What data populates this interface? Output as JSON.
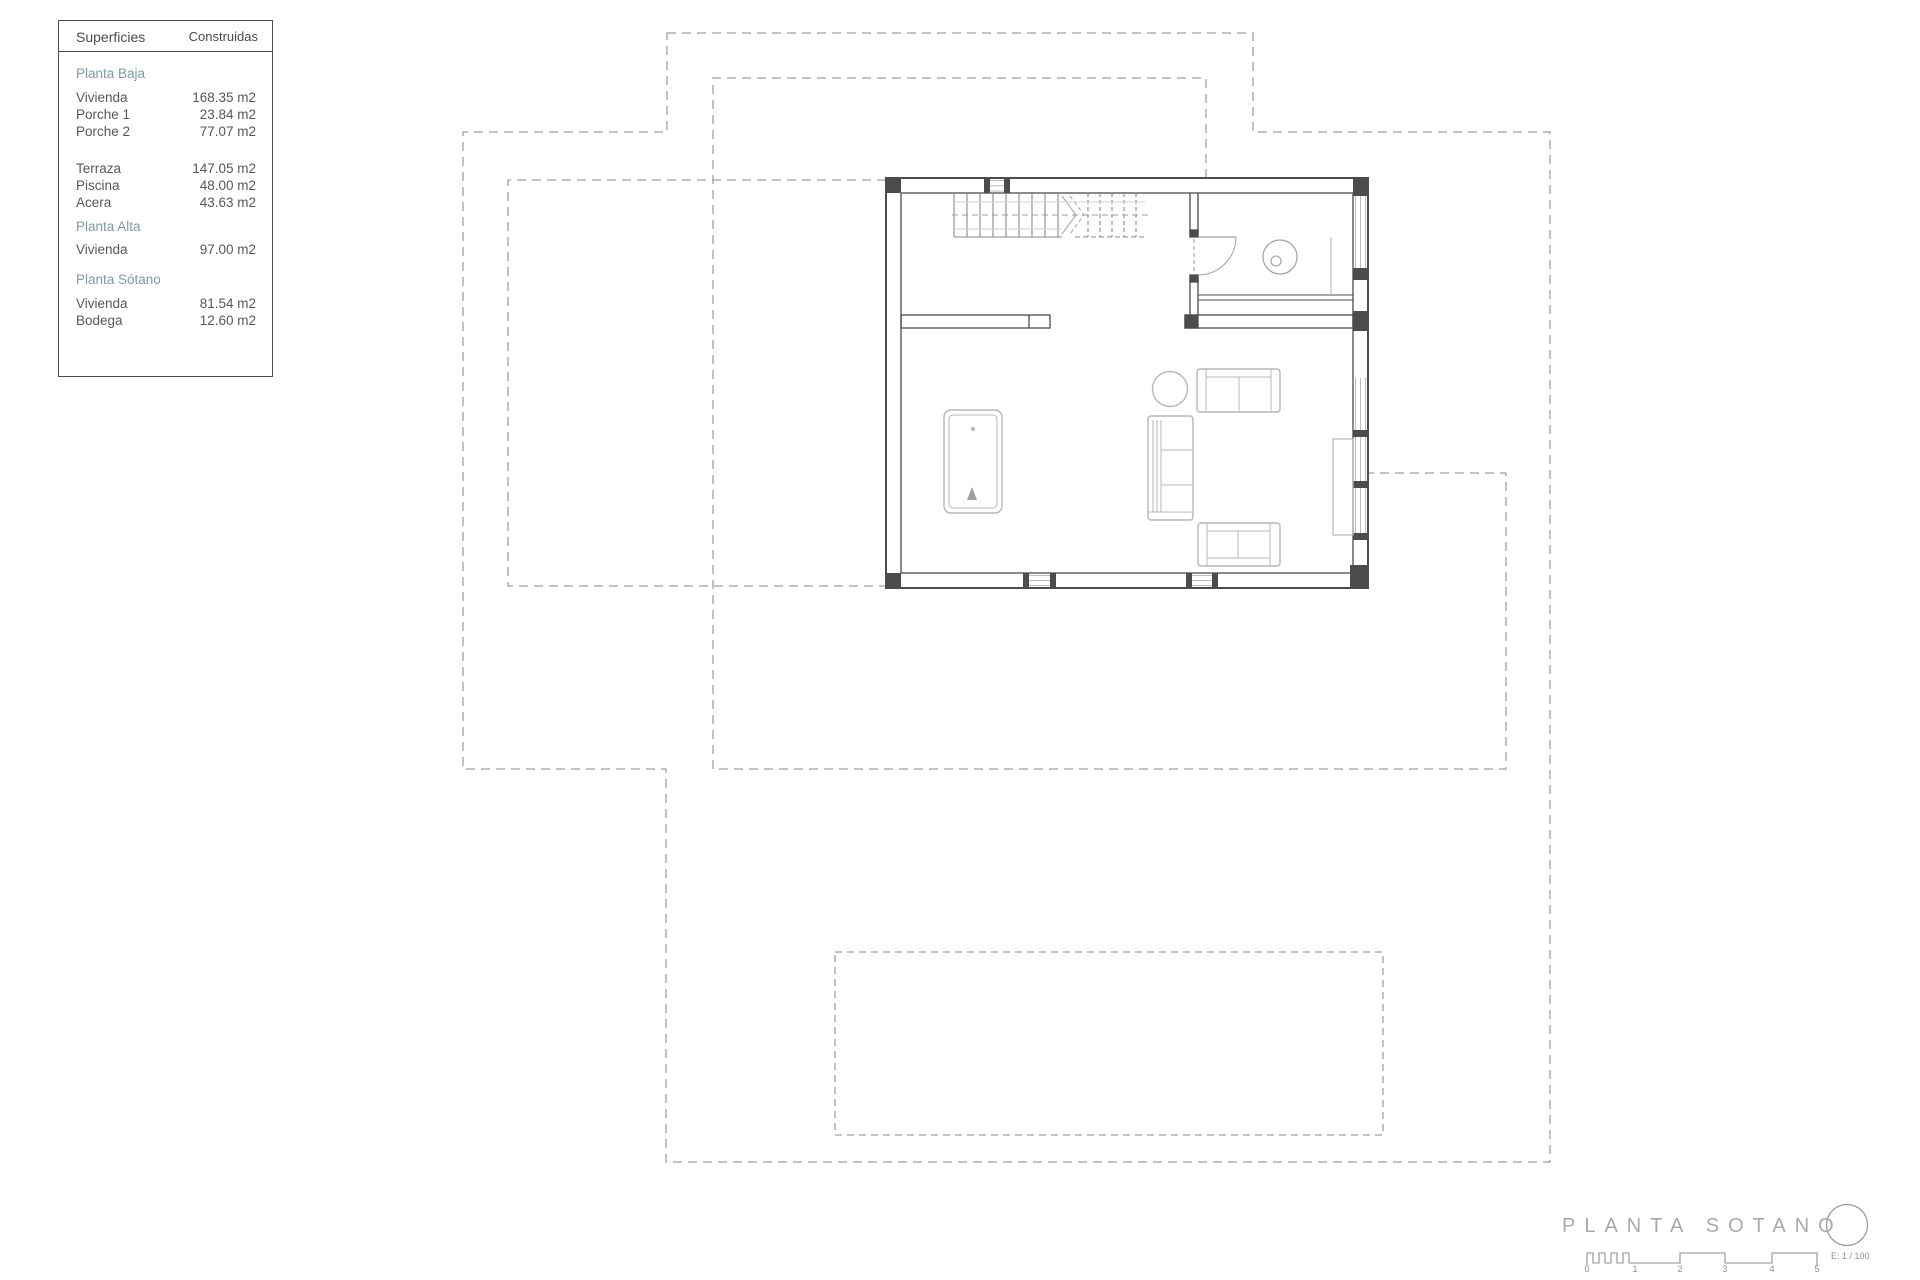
{
  "legend": {
    "col_headers": [
      "Superficies",
      "Construidas"
    ],
    "rows": [
      {
        "kind": "section",
        "label": "Planta Baja"
      },
      {
        "kind": "item",
        "label": "Vivienda",
        "value": "168.35 m2"
      },
      {
        "kind": "item",
        "label": "Porche 1",
        "value": "23.84 m2"
      },
      {
        "kind": "item",
        "label": "Porche 2",
        "value": "77.07 m2"
      },
      {
        "kind": "gap"
      },
      {
        "kind": "item",
        "label": "Terraza",
        "value": "147.05 m2"
      },
      {
        "kind": "item",
        "label": "Piscina",
        "value": "48.00 m2"
      },
      {
        "kind": "item",
        "label": "Acera",
        "value": "43.63 m2"
      },
      {
        "kind": "section",
        "label": "Planta Alta"
      },
      {
        "kind": "item",
        "label": "Vivienda",
        "value": "97.00 m2"
      },
      {
        "kind": "section",
        "label": "Planta Sótano"
      },
      {
        "kind": "item",
        "label": "Vivienda",
        "value": "81.54 m2"
      },
      {
        "kind": "item",
        "label": "Bodega",
        "value": "12.60 m2"
      }
    ]
  },
  "titleblock": {
    "title": "PLANTA SOTANO",
    "scale_label": "E: 1 / 100",
    "ticks": [
      "0",
      "1",
      "2",
      "3",
      "4",
      "5"
    ]
  },
  "colors": {
    "wall": "#4c4c4e",
    "furniture": "#b3b7bb",
    "dashed_outline": "#9aa0a4",
    "section_header": "#7d9aa8",
    "legend_text": "#56575a",
    "title_gray": "#a9a9a9"
  }
}
